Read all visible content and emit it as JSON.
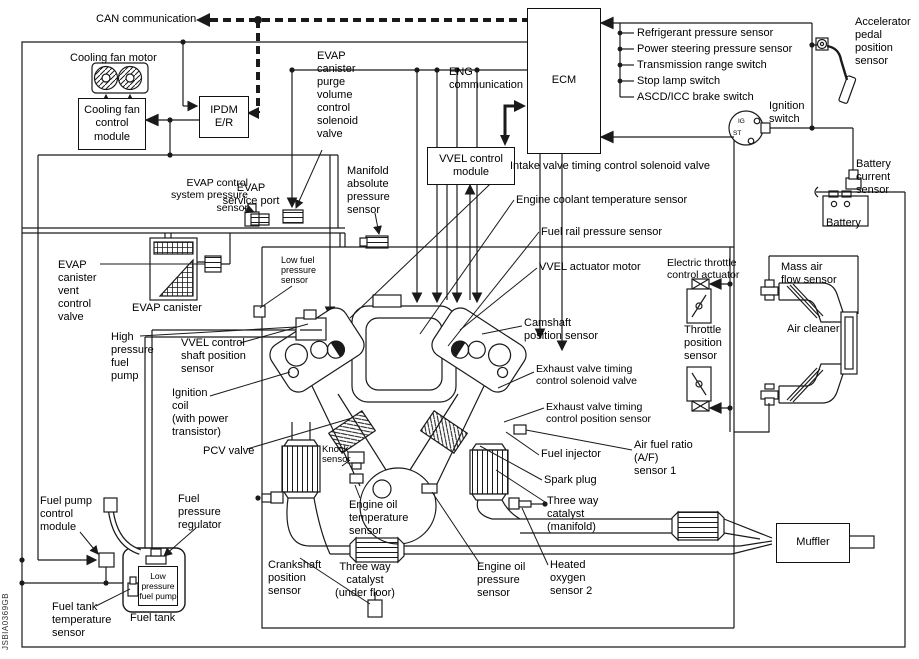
{
  "communication": {
    "can": "CAN communication",
    "eng": "ENG\ncommunication"
  },
  "modules": {
    "ecm": "ECM",
    "ipdm": "IPDM\nE/R",
    "vvel_control": "VVEL control\nmodule",
    "cooling_fan_control": "Cooling fan\ncontrol\nmodule"
  },
  "ecm_inputs": [
    "Refrigerant pressure sensor",
    "Power steering pressure sensor",
    "Transmission range switch",
    "Stop lamp switch",
    "ASCD/ICC brake switch"
  ],
  "components": {
    "cooling_fan_motor": "Cooling fan motor",
    "evap_purge_valve": "EVAP\ncanister\npurge\nvolume\ncontrol\nsolenoid\nvalve",
    "accelerator_pedal": "Accelerator\npedal\nposition\nsensor",
    "ignition_switch": "Ignition\nswitch",
    "battery_current_sensor": "Battery\ncurrent\nsensor",
    "battery": "Battery",
    "intake_valve_timing_solenoid": "Intake valve timing control solenoid valve",
    "engine_coolant_temp_sensor": "Engine coolant temperature sensor",
    "fuel_rail_pressure_sensor": "Fuel rail pressure sensor",
    "vvel_actuator_motor": "VVEL actuator motor",
    "electric_throttle_actuator": "Electric throttle\ncontrol actuator",
    "mass_air_flow_sensor": "Mass air\nflow sensor",
    "air_cleaner": "Air cleaner",
    "camshaft_position_sensor": "Camshaft\nposition sensor",
    "throttle_position_sensor": "Throttle\nposition\nsensor",
    "exhaust_valve_timing_solenoid": "Exhaust valve timing\ncontrol solenoid valve",
    "exhaust_valve_timing_position_sensor": "Exhaust valve timing\ncontrol position sensor",
    "air_fuel_ratio_sensor": "Air fuel ratio\n(A/F)\nsensor 1",
    "fuel_injector": "Fuel injector",
    "spark_plug": "Spark plug",
    "three_way_catalyst_manifold": "Three way\ncatalyst\n(manifold)",
    "evap_control_system_pressure_sensor": "EVAP control\nsystem pressure\nsensor",
    "evap_service_port": "EVAP\nservice port",
    "manifold_absolute_pressure_sensor": "Manifold\nabsolute\npressure\nsensor",
    "low_fuel_pressure_sensor": "Low fuel\npressure\nsensor",
    "evap_canister_vent_valve": "EVAP\ncanister\nvent\ncontrol\nvalve",
    "evap_canister": "EVAP canister",
    "high_pressure_fuel_pump": "High\npressure\nfuel\npump",
    "vvel_control_shaft_position_sensor": "VVEL control\nshaft position\nsensor",
    "ignition_coil": "Ignition\ncoil\n(with power\ntransistor)",
    "pcv_valve": "PCV valve",
    "knock_sensor": "Knock\nsensor",
    "fuel_pump_control_module": "Fuel pump\ncontrol\nmodule",
    "fuel_pressure_regulator": "Fuel\npressure\nregulator",
    "low_pressure_fuel_pump": "Low\npressure\nfuel pump",
    "fuel_tank": "Fuel tank",
    "fuel_tank_temperature_sensor": "Fuel tank\ntemperature\nsensor",
    "crankshaft_position_sensor": "Crankshaft\nposition\nsensor",
    "three_way_catalyst_under_floor": "Three way\ncatalyst\n(under floor)",
    "engine_oil_temperature_sensor": "Engine oil\ntemperature\nsensor",
    "engine_oil_pressure_sensor": "Engine oil\npressure\nsensor",
    "heated_oxygen_sensor_2": "Heated\noxygen\nsensor 2",
    "muffler": "Muffler"
  },
  "ignition_icon": {
    "ig": "IG",
    "st": "ST"
  },
  "figure_code": "JSBIA0369GB",
  "colors": {
    "line": "#1a1a1a",
    "background": "#ffffff"
  }
}
